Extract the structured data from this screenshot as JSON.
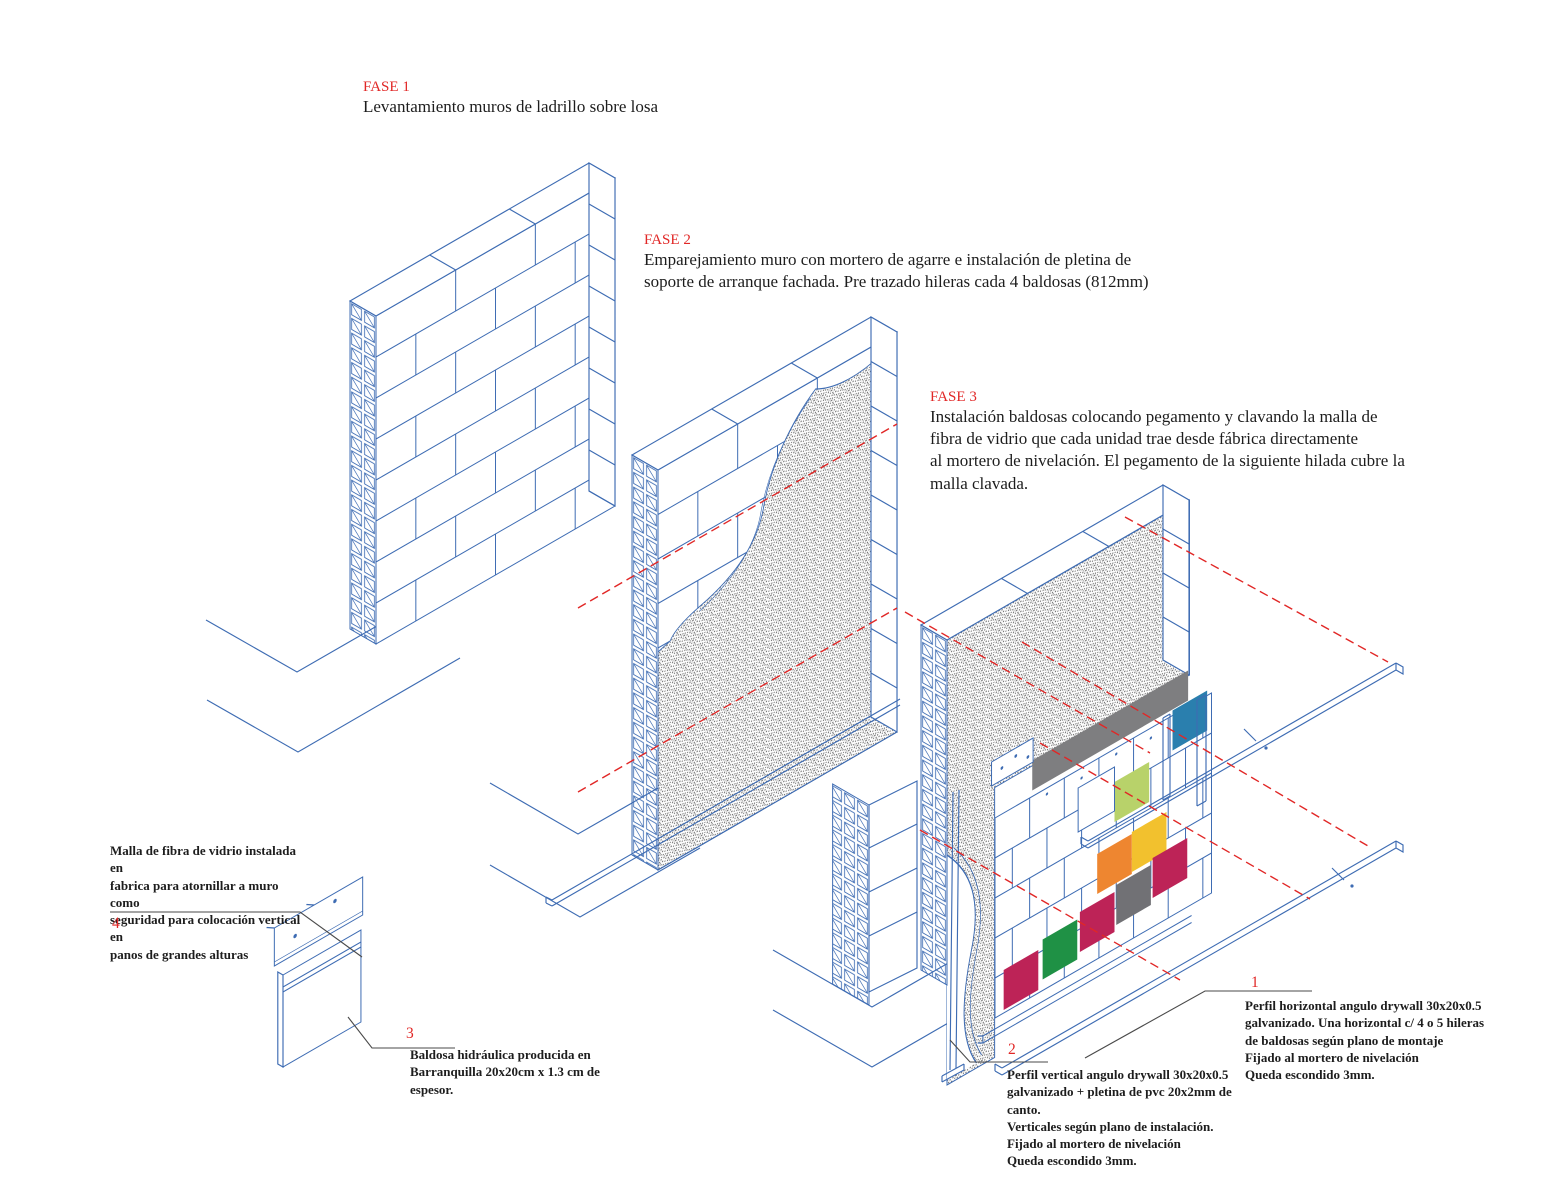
{
  "palette": {
    "line_blue": "#3e6cb3",
    "accent_red": "#e12726",
    "text_dark": "#1d1d1d",
    "leader_gray": "#4a4a4a",
    "stipple_gray": "#646464",
    "band_gray": "#7e7e80"
  },
  "tile_palette": {
    "crimson": "#bd2357",
    "green": "#1f9145",
    "orange": "#ee8630",
    "yellow": "#f2c12e",
    "lime": "#b8d26a",
    "teal": "#2a7fae",
    "gray": "#717175"
  },
  "phases": {
    "fase1": {
      "label": "FASE 1",
      "text": "Levantamiento muros de ladrillo sobre losa"
    },
    "fase2": {
      "label": "FASE 2",
      "text": "Emparejamiento muro con mortero de agarre e instalación de pletina de\nsoporte de arranque fachada. Pre trazado hileras cada 4 baldosas (812mm)"
    },
    "fase3": {
      "label": "FASE 3",
      "text": "Instalación baldosas colocando pegamento y clavando la malla de\nfibra de vidrio que cada unidad trae desde fábrica directamente\nal mortero de nivelación. El pegamento de la siguiente hilada cubre la\nmalla clavada."
    }
  },
  "callouts": {
    "c1": {
      "num": "1",
      "text": "Perfil horizontal angulo drywall 30x20x0.5\ngalvanizado. Una horizontal c/ 4  o 5 hileras\nde baldosas según plano de montaje\nFijado al mortero de nivelación\nQueda escondido 3mm."
    },
    "c2": {
      "num": "2",
      "text": "Perfil vertical angulo drywall 30x20x0.5\ngalvanizado + pletina de pvc 20x2mm de canto.\nVerticales según plano de instalación.\nFijado al mortero de nivelación\nQueda escondido 3mm."
    },
    "c3": {
      "num": "3",
      "text": "Baldosa hidráulica producida en\nBarranquilla 20x20cm x 1.3 cm de espesor."
    },
    "c4": {
      "num": "4",
      "text": "Malla de fibra de vidrio instalada en\nfabrica para atornillar a muro como\nseguridad para colocación vertical en\npanos de grandes alturas"
    }
  }
}
